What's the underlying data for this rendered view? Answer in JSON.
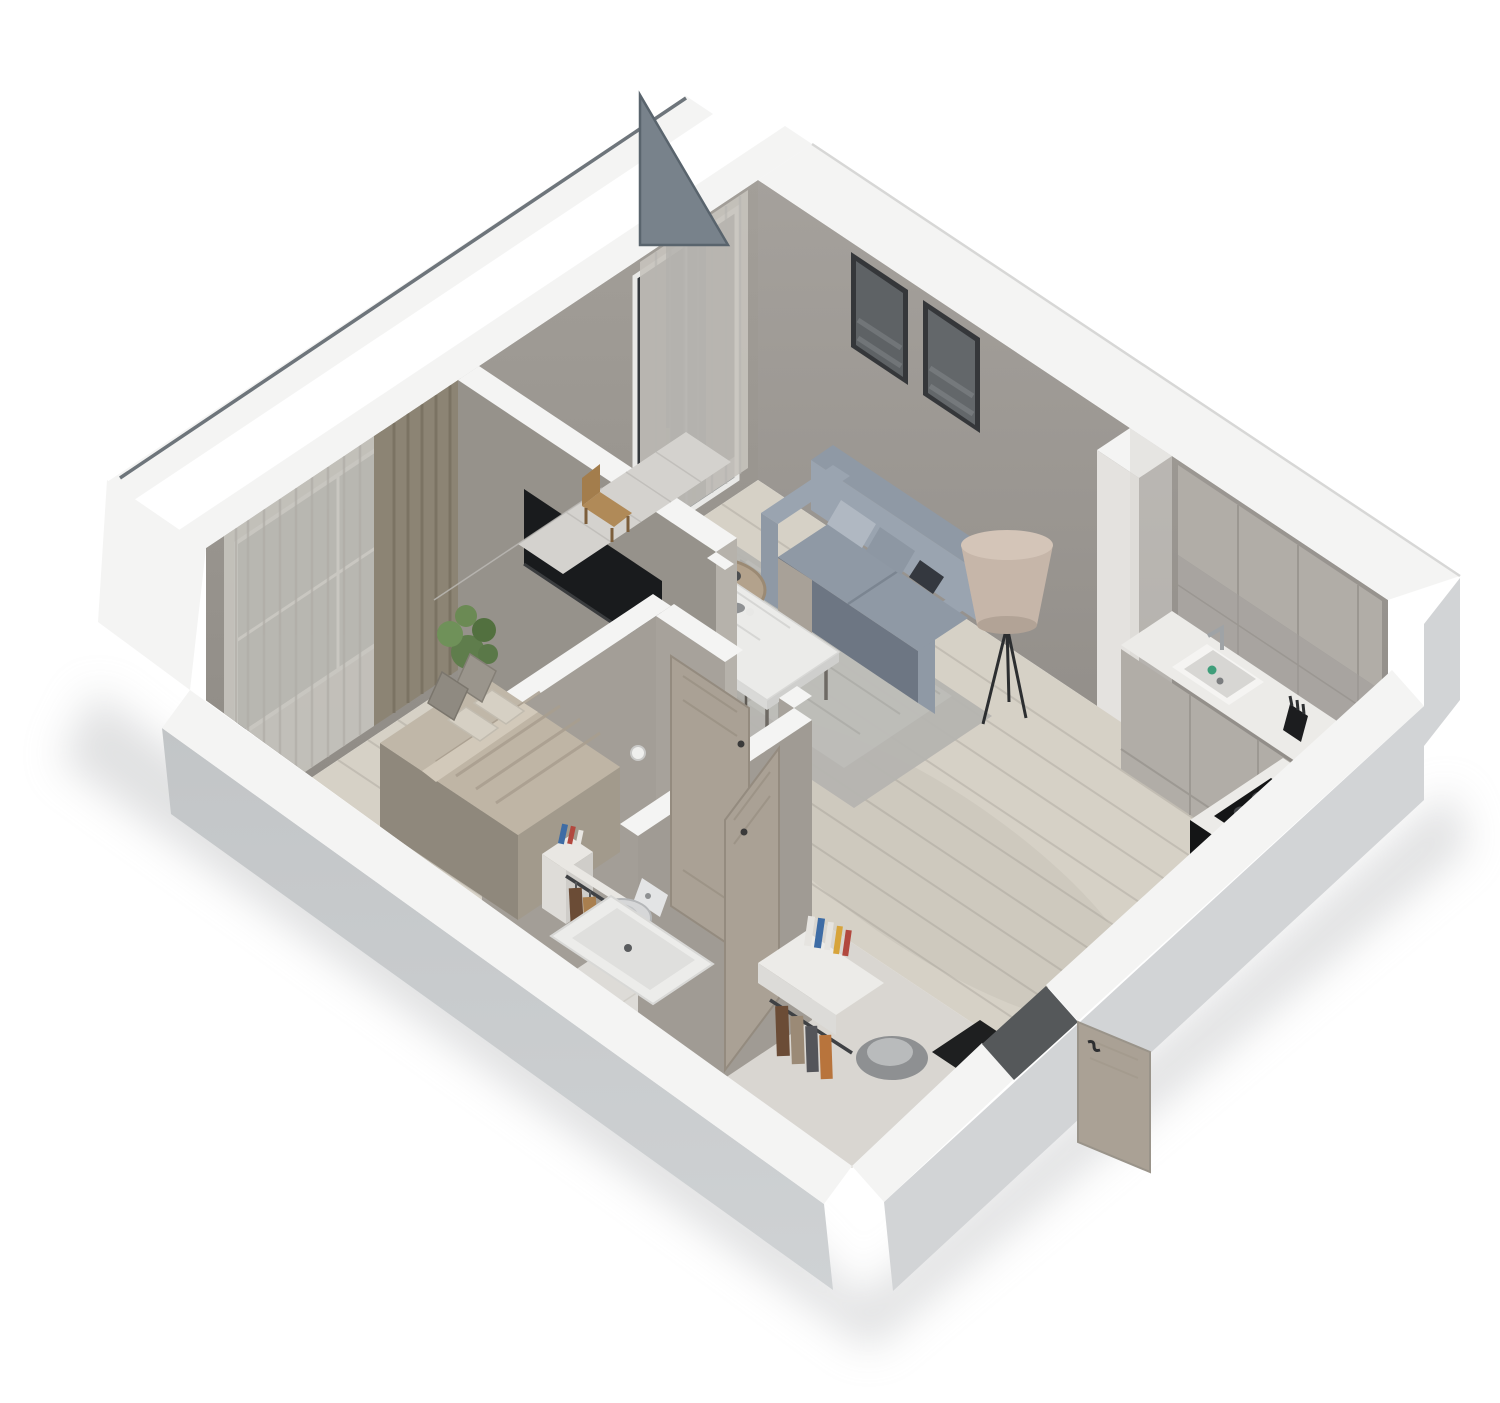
{
  "scene": {
    "title": "3D isometric cutaway floor plan of a one-bedroom apartment",
    "style": "axonometric bird's-eye architectural render, cut walls shown as white bands",
    "background": "white"
  },
  "palette": {
    "bg": "#ffffff",
    "wall_top": "#f4f4f3",
    "exterior_wall": "#c6c8ca",
    "exterior_wall_light": "#d2d4d6",
    "interior_wall": "#9a958f",
    "interior_wall_dark": "#8b8681",
    "floor_wood": "#d6d1c6",
    "floor_plank_line": "#c0bab0",
    "floor_smooth": "#d9d6d1",
    "floor_tile": "#dddbd7",
    "rug": "#b5b4b0",
    "sofa": "#8f99a5",
    "sofa_dark": "#6d7683",
    "sofa_light": "#9aa4b0",
    "bed": "#c0b7a8",
    "bed_dark": "#8f887c",
    "pillow": "#d6d0c4",
    "curtain_dark": "#8c8474",
    "curtain_sheer": "#c6c3bd",
    "door": "#aaa195",
    "counter": "#ecebe8",
    "cabinet": "#b1ada7",
    "appliance": "#141516",
    "glass": "#34383c",
    "glass_panel": "#78828b",
    "plant": "#5f7d4c",
    "art_frame": "#35373a",
    "shadow": "#c8c9cb",
    "lamp": "#c6b6a9",
    "table_white": "#ebebe9",
    "chair": "#b5aea3",
    "book_blue": "#3e6ca5",
    "book_yellow": "#d7a43b",
    "book_red": "#b2483e",
    "clothes_brown": "#6b4c36",
    "clothes_tan": "#a97f4f",
    "clothes_orange": "#b8743c",
    "clothes_gray": "#74767a"
  },
  "rooms": [
    {
      "id": "living-room",
      "label": "Living room",
      "furniture": [
        "gray fabric sofa",
        "throw pillows",
        "two framed wall artworks",
        "tripod floor lamp",
        "round pouf",
        "round coffee table",
        "area rug",
        "sheer curtains",
        "balcony glass door"
      ]
    },
    {
      "id": "dining-area",
      "label": "Dining area",
      "furniture": [
        "white marble dining table",
        "three upholstered chairs",
        "flower vase",
        "black decor piece",
        "bowl"
      ]
    },
    {
      "id": "kitchen",
      "label": "Kitchen",
      "furniture": [
        "L-shaped counter",
        "white sink with faucet",
        "black cooktop with four burners",
        "upper cabinets",
        "backsplash",
        "knife block",
        "black appliance end panel"
      ]
    },
    {
      "id": "bedroom",
      "label": "Bedroom",
      "furniture": [
        "platform double bed",
        "headboard cushions",
        "layered duvet",
        "white nightstand with books",
        "open clothes rack with hangers",
        "potted plant",
        "dark and sheer curtains",
        "black framed window",
        "TV wall niche"
      ]
    },
    {
      "id": "bathroom",
      "label": "Bathroom",
      "furniture": [
        "wall-hung toilet",
        "toilet paper holder",
        "bathtub",
        "waste bin",
        "bathroom door"
      ]
    },
    {
      "id": "hallway",
      "label": "Hallway / entry",
      "furniture": [
        "entry door (open)",
        "dark doormat",
        "white console shelf with books",
        "coat rail with hanging clothes",
        "curved chair",
        "bedroom door (open)"
      ]
    },
    {
      "id": "balcony",
      "label": "Balcony",
      "furniture": [
        "glass balustrade panel",
        "tiled floor",
        "wooden chair"
      ]
    }
  ]
}
